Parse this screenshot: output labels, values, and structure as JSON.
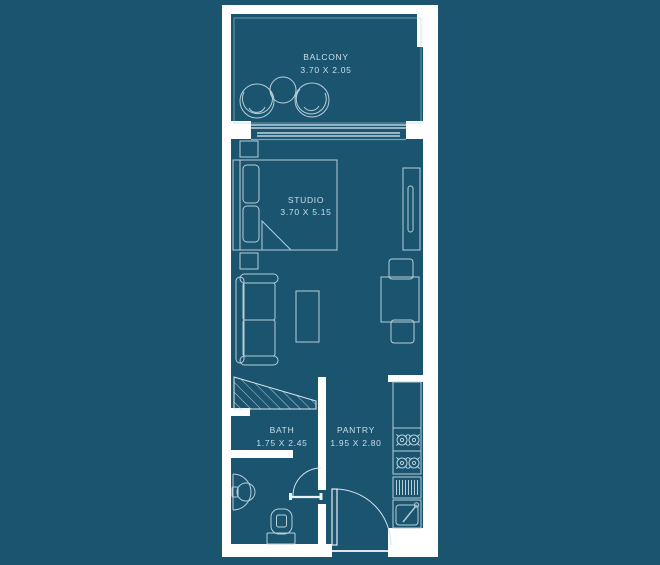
{
  "colors": {
    "background": "#1A546F",
    "wall": "#FFFFFF",
    "furniture_line": "#B7CFDA",
    "door_line": "#E4EEF3",
    "label_text": "#CBDFE9"
  },
  "rooms": [
    {
      "name": "BALCONY",
      "dimensions": "3.70 X 2.05"
    },
    {
      "name": "STUDIO",
      "dimensions": "3.70 X 5.15"
    },
    {
      "name": "BATH",
      "dimensions": "1.75 X 2.45"
    },
    {
      "name": "PANTRY",
      "dimensions": "1.95 X 2.80"
    }
  ]
}
